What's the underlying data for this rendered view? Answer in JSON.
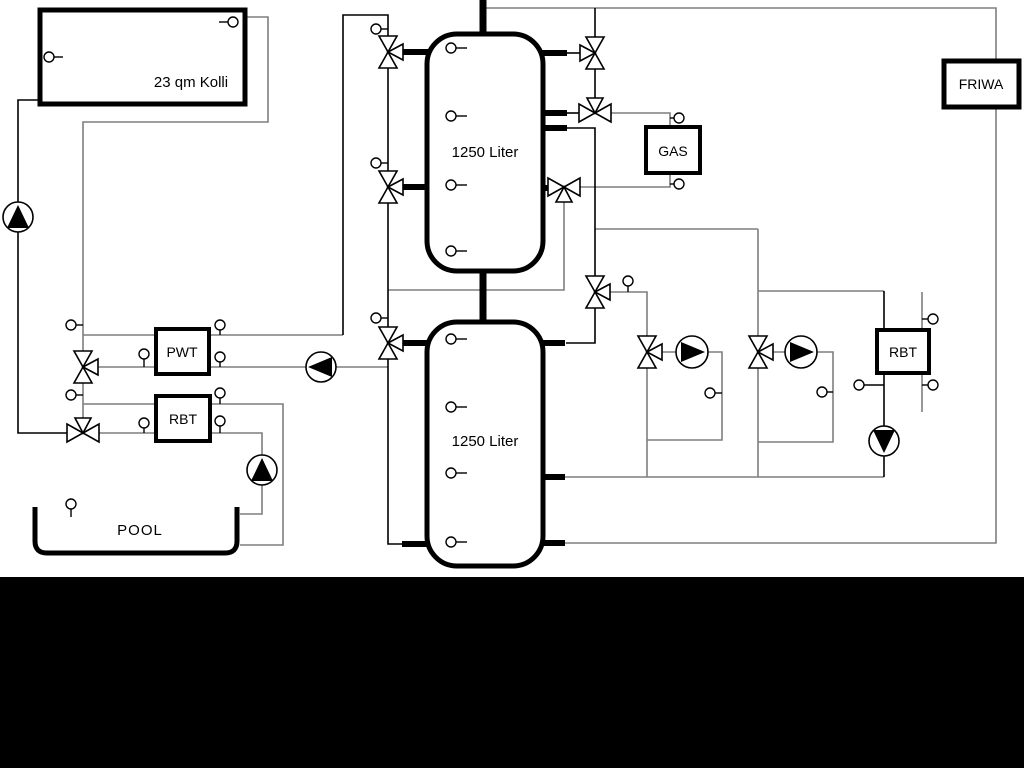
{
  "labels": {
    "collector": "23 qm Kolli",
    "tank_top": "1250 Liter",
    "tank_bottom": "1250 Liter",
    "pwt": "PWT",
    "rbt_left": "RBT",
    "rbt_right": "RBT",
    "gas": "GAS",
    "friwa": "FRIWA",
    "pool": "POOL"
  },
  "colors": {
    "background": "#ffffff",
    "pipe_gray": "#7f7f7f",
    "pipe_black": "#000000",
    "letterbox_bar": "#000000"
  },
  "symbols": {
    "three_way_valve": "bowtie of outline triangles with third triangle toward center",
    "pump": "circle with filled triangle showing flow direction",
    "temp_sensor": "small circle with short stem"
  }
}
